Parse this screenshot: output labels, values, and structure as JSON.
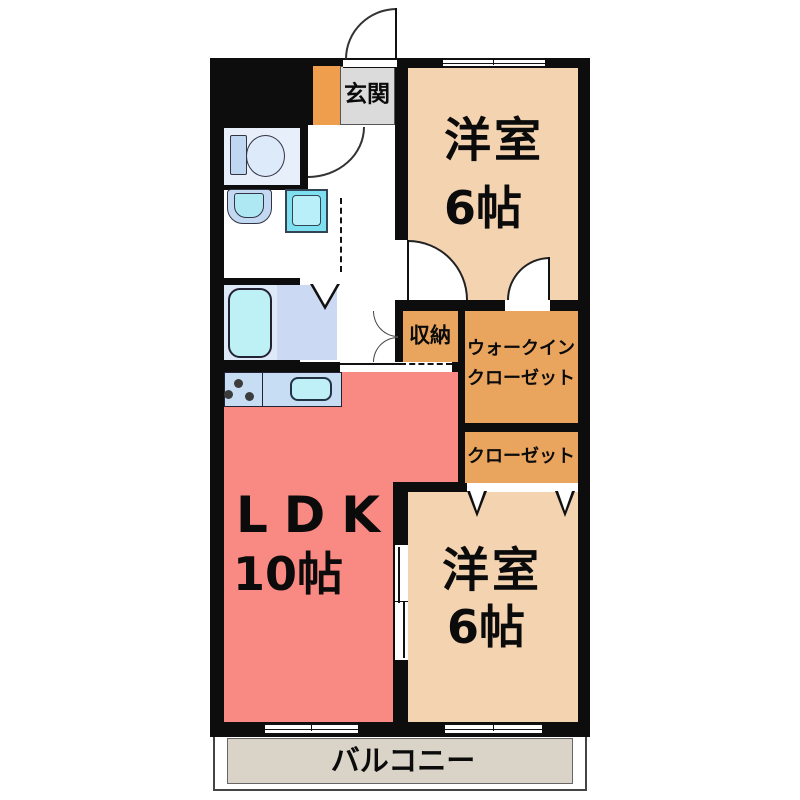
{
  "floorplan": {
    "type": "japanese-apartment-floor-plan-2LDK",
    "colors": {
      "wall": "#0d0d0d",
      "bedroom_fill": "#F4D3B1",
      "closet_fill": "#E9A45D",
      "ldk_fill": "#F98983",
      "entrance_orange": "#EF9E4E",
      "entrance_gray": "#DBDBDB",
      "balcony_fill": "#DAD3C8",
      "bathroom_fill": "#CBDAF2",
      "toilet_fill": "#E7F0FA",
      "kitchen_counter_fill": "#C6DDF4",
      "fixture_cyan": "#AEE9F3"
    },
    "rooms": {
      "entrance": {
        "label": "玄関"
      },
      "bedroom_top": {
        "label": "洋室",
        "size": "6帖"
      },
      "storage": {
        "label": "収納"
      },
      "walk_in_closet": {
        "label_line1": "ウォークイン",
        "label_line2": "クローゼット"
      },
      "closet": {
        "label": "クローゼット"
      },
      "ldk": {
        "label": "LDK",
        "size": "10帖"
      },
      "bedroom_bottom": {
        "label": "洋室",
        "size": "6帖"
      },
      "balcony": {
        "label": "バルコニー"
      }
    }
  }
}
